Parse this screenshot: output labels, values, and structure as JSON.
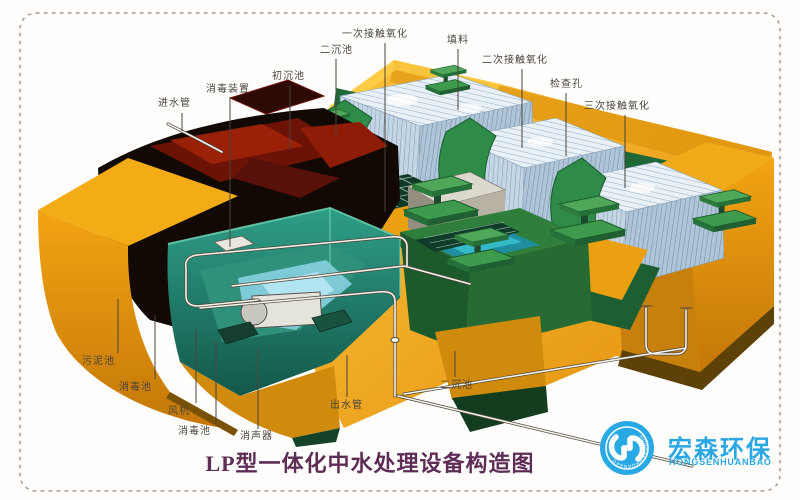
{
  "figure": {
    "title": "LP型一体化中水处理设备构造图",
    "subject": "integrated-water-treatment-equipment-cutaway"
  },
  "labels": {
    "top": [
      {
        "part": "inlet-pipe",
        "text": "进水管"
      },
      {
        "part": "disinfection-device",
        "text": "消毒装置"
      },
      {
        "part": "primary-sedimentation-tank",
        "text": "初沉池"
      },
      {
        "part": "secondary-sedimentation-tank",
        "text": "二沉池"
      },
      {
        "part": "primary-contact-oxidation",
        "text": "一次接触氧化"
      },
      {
        "part": "packing-media",
        "text": "填料"
      },
      {
        "part": "secondary-contact-oxidation",
        "text": "二次接触氧化"
      },
      {
        "part": "inspection-hole",
        "text": "检查孔"
      },
      {
        "part": "tertiary-contact-oxidation",
        "text": "三次接触氧化"
      }
    ],
    "bottom": [
      {
        "part": "sludge-tank",
        "text": "污泥池"
      },
      {
        "part": "disinfection-tank",
        "text": "消毒池"
      },
      {
        "part": "blower",
        "text": "风机"
      },
      {
        "part": "disinfection-tank-2",
        "text": "消毒池"
      },
      {
        "part": "silencer",
        "text": "消声器"
      },
      {
        "part": "outlet-pipe",
        "text": "出水管"
      },
      {
        "part": "secondary-sedimentation-tank-2",
        "text": "二沉池"
      }
    ]
  },
  "logo": {
    "name_cn": "宏森环保",
    "name_en": "HONGSENHUANBAO",
    "ring_text": "HONGSENHUANBAO",
    "brand_color": "#2aa7e3"
  },
  "colors": {
    "body_orange": "#f0a014",
    "tank_green": "#2e8b45",
    "chamber_teal": "#2e9e86",
    "cavity_dark": "#120905",
    "packing_white": "#e9f1f7",
    "title_color": "#5e2d55",
    "label_color": "#4a443c",
    "border_dash": "#a39288"
  }
}
